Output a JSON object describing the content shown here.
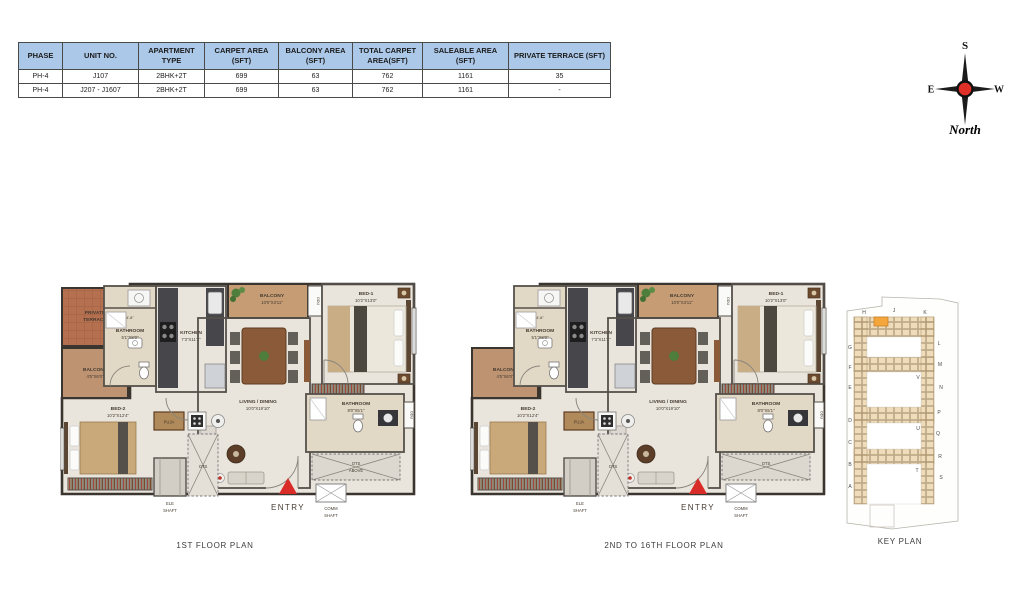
{
  "table": {
    "headers": [
      "PHASE",
      "UNIT NO.",
      "APARTMENT TYPE",
      "CARPET AREA (SFT)",
      "BALCONY AREA (SFT)",
      "TOTAL CARPET AREA(SFT)",
      "SALEABLE AREA (SFT)",
      "PRIVATE TERRACE (SFT)"
    ],
    "rows": [
      [
        "PH-4",
        "J107",
        "2BHK+2T",
        "699",
        "63",
        "762",
        "1161",
        "35"
      ],
      [
        "PH-4",
        "J207 - J1607",
        "2BHK+2T",
        "699",
        "63",
        "762",
        "1161",
        "-"
      ]
    ]
  },
  "compass": {
    "top": "S",
    "left": "E",
    "right": "W",
    "bottom": "North"
  },
  "plans": [
    {
      "title": "1ST FLOOR PLAN",
      "entry": "ENTRY",
      "rooms": {
        "private_terrace": {
          "l1": "PRIVATE",
          "l2": "TERRACE"
        },
        "balcony_left": {
          "name": "BALCONY",
          "dims": "4'5\"X6'0\""
        },
        "bed2": {
          "name": "BED-2",
          "dims": "10'2\"X12'4\""
        },
        "bathroom_top": {
          "name": "BATHROOM",
          "dims": "5'1\"X8'0\"",
          "dim_note": "4'-8\""
        },
        "kitchen": {
          "name": "KITCHEN",
          "dims": "7'3\"X11'2\""
        },
        "balcony_top": {
          "name": "BALCONY",
          "dims": "10'0\"X3'11\""
        },
        "bed1": {
          "name": "BED-1",
          "dims": "10'2\"X13'0\""
        },
        "living": {
          "name": "LIVING / DINING",
          "dims": "10'0\"X19'10\""
        },
        "bathroom_bottom": {
          "name": "BATHROOM",
          "dims": "8'0\"X5'1\""
        },
        "puja": "PUJA",
        "ots_mid": "OTS",
        "ots_corner": {
          "l1": "OTS",
          "l2": "ABOVE"
        },
        "ele_shaft": {
          "l1": "ELE",
          "l2": "SHAFT"
        },
        "comm_shaft": {
          "l1": "COMM",
          "l2": "SHAFT"
        },
        "odu": "ODU"
      }
    },
    {
      "title": "2ND TO 16TH FLOOR PLAN",
      "entry": "ENTRY",
      "rooms": {
        "balcony_left": {
          "name": "BALCONY",
          "dims": "4'5\"X6'0\""
        },
        "bed2": {
          "name": "BED-2",
          "dims": "10'2\"X12'4\""
        },
        "bathroom_top": {
          "name": "BATHROOM",
          "dims": "5'1\"X8'0\"",
          "dim_note": "4'-8\""
        },
        "kitchen": {
          "name": "KITCHEN",
          "dims": "7'3\"X11'2\""
        },
        "balcony_top": {
          "name": "BALCONY",
          "dims": "10'0\"X3'11\""
        },
        "bed1": {
          "name": "BED-1",
          "dims": "10'2\"X13'0\""
        },
        "living": {
          "name": "LIVING / DINING",
          "dims": "10'0\"X19'10\""
        },
        "bathroom_bottom": {
          "name": "BATHROOM",
          "dims": "8'0\"X5'1\""
        },
        "puja": "PUJA",
        "ots_mid": "OTS",
        "ots_corner": {
          "l1": "OTS",
          "l2": ""
        },
        "ele_shaft": {
          "l1": "ELE",
          "l2": "SHAFT"
        },
        "comm_shaft": {
          "l1": "COMM",
          "l2": "SHAFT"
        },
        "odu": "ODU"
      }
    }
  ],
  "key_plan": {
    "title": "KEY PLAN",
    "top": [
      "H",
      "J",
      "K"
    ],
    "left": [
      "G",
      "F",
      "E",
      "D",
      "C",
      "B",
      "A"
    ],
    "right": [
      "L",
      "M",
      "N",
      "P",
      "Q",
      "R",
      "S"
    ],
    "mid": [
      "V",
      "U",
      "T"
    ]
  },
  "colors": {
    "accent_red": "#d92b27",
    "table_header": "#abc8e8",
    "highlight": "#f2a63c"
  }
}
